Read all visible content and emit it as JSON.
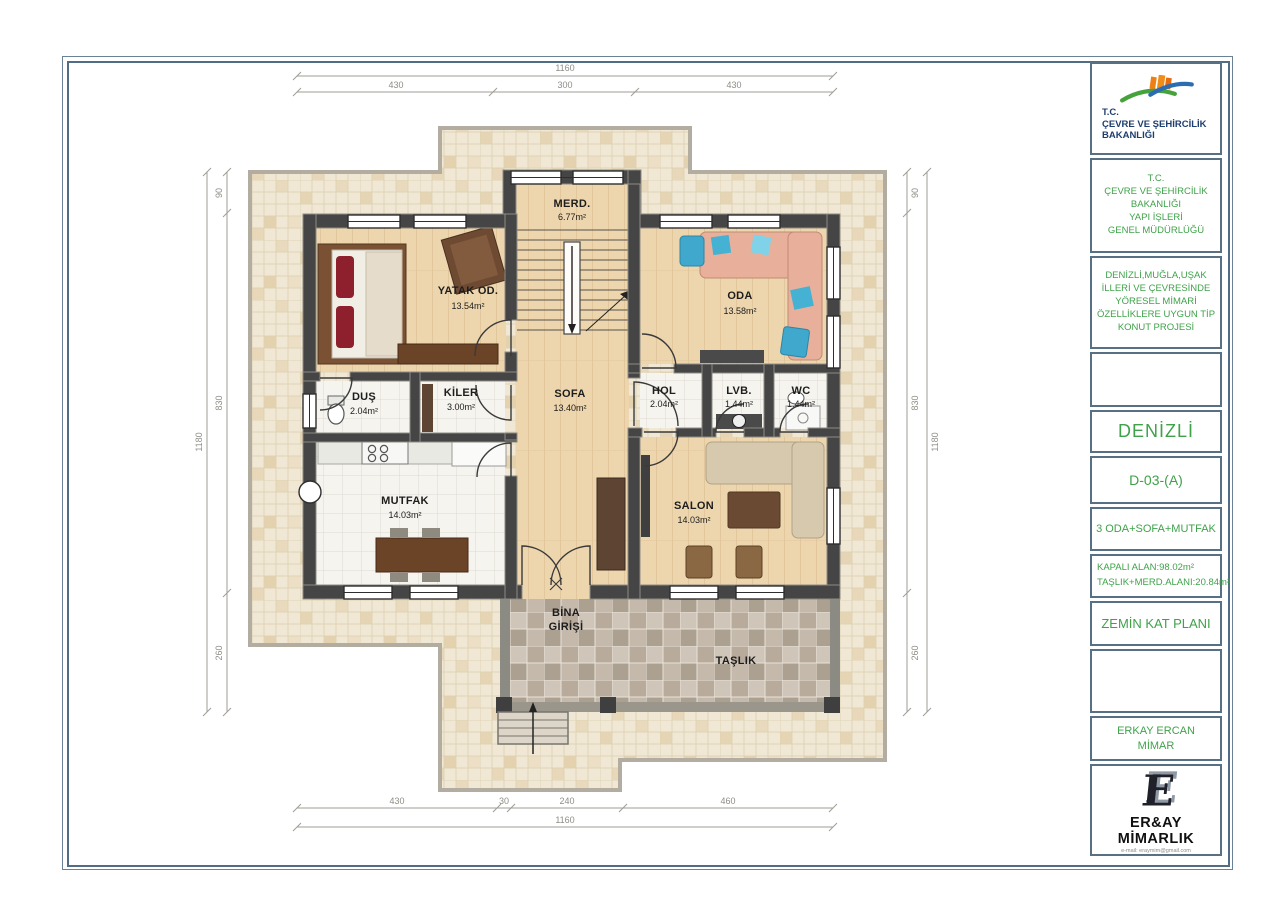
{
  "title_block": {
    "ministry_logo": {
      "lines": [
        "T.C.",
        "ÇEVRE VE ŞEHİRCİLİK",
        "BAKANLIĞI"
      ]
    },
    "ministry": {
      "lines": [
        "T.C.",
        "ÇEVRE VE ŞEHİRCİLİK",
        "BAKANLIĞI",
        "YAPI İŞLERİ",
        "GENEL MÜDÜRLÜĞÜ"
      ]
    },
    "project": {
      "lines": [
        "DENİZLİ,MUĞLA,UŞAK",
        "İLLERİ VE ÇEVRESİNDE",
        "YÖRESEL MİMARİ",
        "ÖZELLİKLERE UYGUN TİP",
        "KONUT PROJESİ"
      ]
    },
    "city": "DENİZLİ",
    "code": "D-03-(A)",
    "program": "3 ODA+SOFA+MUTFAK",
    "areas": {
      "line1": "KAPALI ALAN:98.02m²",
      "line2": "TAŞLIK+MERD.ALANI:20.84m²"
    },
    "plan_name": "ZEMİN KAT PLANI",
    "architect": {
      "line1": "ERKAY ERCAN",
      "line2": "MİMAR"
    },
    "firm": {
      "name": "ER&AY MİMARLIK",
      "email": "e-mail: eraymim@gmail.com"
    }
  },
  "rooms": {
    "merd": {
      "name": "MERD.",
      "area": "6.77m²"
    },
    "yatak": {
      "name": "YATAK OD.",
      "area": "13.54m²"
    },
    "oda": {
      "name": "ODA",
      "area": "13.58m²"
    },
    "dus": {
      "name": "DUŞ",
      "area": "2.04m²"
    },
    "kiler": {
      "name": "KİLER",
      "area": "3.00m²"
    },
    "sofa": {
      "name": "SOFA",
      "area": "13.40m²"
    },
    "hol": {
      "name": "HOL",
      "area": "2.04m²"
    },
    "lvb": {
      "name": "LVB.",
      "area": "1.44m²"
    },
    "wc": {
      "name": "WC",
      "area": "1.44m²"
    },
    "mutfak": {
      "name": "MUTFAK",
      "area": "14.03m²"
    },
    "salon": {
      "name": "SALON",
      "area": "14.03m²"
    },
    "bina_girisi": {
      "line1": "BİNA",
      "line2": "GİRİŞİ"
    },
    "taslik": {
      "name": "TAŞLIK"
    }
  },
  "dimensions": {
    "top": {
      "total": "1160",
      "segments": [
        "430",
        "300",
        "430"
      ]
    },
    "bottom": {
      "total": "1160",
      "segments": [
        "430",
        "30",
        "240",
        "460"
      ]
    },
    "left": {
      "total": "1180",
      "segments": [
        "90",
        "830",
        "260"
      ]
    },
    "right": {
      "total": "1180",
      "segments": [
        "90",
        "830",
        "260"
      ]
    }
  },
  "appearance": {
    "accent_green": "#3fa24a",
    "ministry_navy": "#1d3e6f",
    "frame_blue": "#506d85",
    "wall_gray": "#454545",
    "wood_floor": "#edd6ae",
    "plot_tile": "#f0e7d4",
    "terrace_checker_dark": "#b9ab9c",
    "logo_orange": "#ef8c1a",
    "logo_green": "#46a33c",
    "logo_blue": "#2b6cb3"
  }
}
